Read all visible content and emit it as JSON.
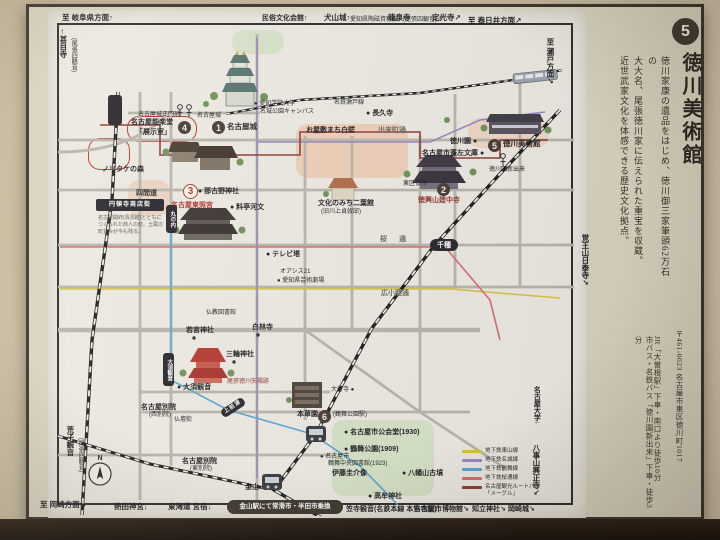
{
  "panel": {
    "badge_number": "5",
    "title": "徳川美術館",
    "body_lines": [
      "徳川家康の遺品をはじめ、徳川御三家筆頭62万石の",
      "大大名、尾張徳川家に伝えられた重宝を収蔵。",
      "近世武家文化を体感できる歴史文化拠点。"
    ],
    "address": "〒461-0023 名古屋市東区徳川町1017",
    "access_lines": [
      "JR「大曽根駅」下車・南口より徒歩10分",
      "市バス・名鉄バス「徳川園新出来」下車・徒歩3分"
    ]
  },
  "map": {
    "compass": "N",
    "labels": [
      {
        "t": "至 岐阜県方面↑",
        "x": 62,
        "y": 14,
        "c": "m"
      },
      {
        "t": "民俗文化会館↑",
        "x": 262,
        "y": 15,
        "c": "sm"
      },
      {
        "t": "犬山城↑",
        "x": 324,
        "y": 14,
        "c": "m"
      },
      {
        "t": "愛知県陶磁資料館↗",
        "x": 350,
        "y": 17,
        "c": "xs"
      },
      {
        "t": "龍泉寺",
        "x": 388,
        "y": 14,
        "c": "m"
      },
      {
        "t": "(尾張四観音)↗",
        "x": 403,
        "y": 17,
        "c": "xs"
      },
      {
        "t": "定光寺↗",
        "x": 432,
        "y": 14,
        "c": "m"
      },
      {
        "t": "至 春日井方面↗",
        "x": 468,
        "y": 17,
        "c": "m"
      },
      {
        "t": "←甚目寺",
        "x": 59,
        "y": 28,
        "c": "m vert"
      },
      {
        "t": "(尾張四観音)",
        "x": 70,
        "y": 38,
        "c": "xs vert"
      },
      {
        "t": "至 瀬戸方面↗",
        "x": 546,
        "y": 38,
        "c": "m vert"
      },
      {
        "t": "覚王山日泰寺↗",
        "x": 581,
        "y": 234,
        "c": "m vert"
      },
      {
        "t": "名古屋大学↓",
        "x": 533,
        "y": 386,
        "c": "sm vert"
      },
      {
        "t": "八事山興正寺↘",
        "x": 532,
        "y": 444,
        "c": "m vert"
      },
      {
        "t": "荒子観音",
        "x": 66,
        "y": 426,
        "c": "m vert"
      },
      {
        "t": "(尾張四観音)",
        "x": 77,
        "y": 438,
        "c": "xs vert"
      },
      {
        "t": "至 岡崎方面↘",
        "x": 40,
        "y": 501,
        "c": "m"
      },
      {
        "t": "熱田神宮↓",
        "x": 114,
        "y": 503,
        "c": "m"
      },
      {
        "t": "東海道 宮宿↓",
        "x": 168,
        "y": 503,
        "c": "m"
      },
      {
        "t": "笠寺観音(名鉄本線 本笠寺駅)↓",
        "x": 346,
        "y": 506,
        "c": "sm"
      },
      {
        "t": "名古屋市博物館↘",
        "x": 414,
        "y": 506,
        "c": "sm"
      },
      {
        "t": "知立神社↘",
        "x": 472,
        "y": 506,
        "c": "sm"
      },
      {
        "t": "岡崎城↘",
        "x": 508,
        "y": 506,
        "c": "sm"
      },
      {
        "t": "名古屋城正門前",
        "x": 138,
        "y": 112,
        "c": "xs"
      },
      {
        "t": "名古屋城",
        "x": 197,
        "y": 113,
        "c": "xs"
      },
      {
        "t": "名古屋能楽堂",
        "x": 131,
        "y": 119,
        "c": "sm"
      },
      {
        "t": "「展示室」",
        "x": 136,
        "y": 129,
        "c": "sm"
      },
      {
        "t": "名古屋城",
        "x": 227,
        "y": 123,
        "c": "poi"
      },
      {
        "t": "● 愛知学院大学",
        "x": 254,
        "y": 101,
        "c": "xs"
      },
      {
        "t": "名城公園キャンパス",
        "x": 260,
        "y": 109,
        "c": "xs"
      },
      {
        "t": "名鉄瀬戸線",
        "x": 334,
        "y": 100,
        "c": "xs"
      },
      {
        "t": "● 長久寺",
        "x": 366,
        "y": 110,
        "c": "sm"
      },
      {
        "t": "出来町通",
        "x": 378,
        "y": 127,
        "c": "street"
      },
      {
        "t": "お屋敷まち白壁",
        "x": 306,
        "y": 127,
        "c": "sm"
      },
      {
        "t": "文化のみち二葉館",
        "x": 318,
        "y": 200,
        "c": "sm"
      },
      {
        "t": "(旧川上貞奴邸)",
        "x": 321,
        "y": 209,
        "c": "xs"
      },
      {
        "t": "徳川園 ●",
        "x": 450,
        "y": 138,
        "c": "sm"
      },
      {
        "t": "徳川美術館",
        "x": 503,
        "y": 140,
        "c": "poi"
      },
      {
        "t": "名古屋市蓬左文庫 ●",
        "x": 422,
        "y": 150,
        "c": "sm"
      },
      {
        "t": "東区役所",
        "x": 403,
        "y": 181,
        "c": "xs"
      },
      {
        "t": "徳興山建中寺",
        "x": 418,
        "y": 197,
        "c": "sm darkred"
      },
      {
        "t": "徳川園新出来",
        "x": 489,
        "y": 167,
        "c": "xs"
      },
      {
        "t": "● 那古野神社",
        "x": 198,
        "y": 188,
        "c": "sm"
      },
      {
        "t": "● 料亭河文",
        "x": 230,
        "y": 204,
        "c": "sm"
      },
      {
        "t": "名古屋東照宮",
        "x": 171,
        "y": 202,
        "c": "sm red"
      },
      {
        "t": "四間道",
        "x": 136,
        "y": 190,
        "c": "sm"
      },
      {
        "t": "ノリタケの森",
        "x": 102,
        "y": 166,
        "c": "sm"
      },
      {
        "t": "名古屋開府(清須越)とともに",
        "x": 98,
        "y": 216,
        "c": "xxs"
      },
      {
        "t": "つくられた商人の町。土蔵の",
        "x": 98,
        "y": 223,
        "c": "xxs"
      },
      {
        "t": "町並みが今も残る。",
        "x": 98,
        "y": 230,
        "c": "xxs"
      },
      {
        "t": "● テレビ塔",
        "x": 266,
        "y": 251,
        "c": "sm"
      },
      {
        "t": "オアシス21",
        "x": 280,
        "y": 269,
        "c": "xs"
      },
      {
        "t": "● 愛知県芸術劇場",
        "x": 277,
        "y": 278,
        "c": "xs"
      },
      {
        "t": "桜 通",
        "x": 380,
        "y": 236,
        "c": "street sp"
      },
      {
        "t": "広小路通",
        "x": 381,
        "y": 290,
        "c": "street"
      },
      {
        "t": "仏教図書館",
        "x": 206,
        "y": 310,
        "c": "xs"
      },
      {
        "t": "若宮神社",
        "x": 186,
        "y": 327,
        "c": "sm"
      },
      {
        "t": "白林寺",
        "x": 252,
        "y": 324,
        "c": "sm"
      },
      {
        "t": "三輪神社",
        "x": 226,
        "y": 351,
        "c": "sm"
      },
      {
        "t": "尾張徳川矢場跡",
        "x": 227,
        "y": 379,
        "c": "xs darkred"
      },
      {
        "t": "● 大須観音",
        "x": 177,
        "y": 384,
        "c": "sm"
      },
      {
        "t": "名古屋別院",
        "x": 141,
        "y": 404,
        "c": "sm"
      },
      {
        "t": "(西別院)",
        "x": 149,
        "y": 412,
        "c": "xs"
      },
      {
        "t": "仏壇街",
        "x": 174,
        "y": 417,
        "c": "xs"
      },
      {
        "t": "名古屋別院",
        "x": 182,
        "y": 458,
        "c": "sm"
      },
      {
        "t": "(東別院)",
        "x": 190,
        "y": 466,
        "c": "xs"
      },
      {
        "t": "大行寺 ●",
        "x": 331,
        "y": 387,
        "c": "xs"
      },
      {
        "t": "本草園",
        "x": 297,
        "y": 411,
        "c": "sm"
      },
      {
        "t": "(鶴舞公園駅)",
        "x": 333,
        "y": 412,
        "c": "xs"
      },
      {
        "t": "● 名古屋市公会堂(1930)",
        "x": 344,
        "y": 429,
        "c": "sm"
      },
      {
        "t": "● 鶴舞公園(1909)",
        "x": 344,
        "y": 446,
        "c": "sm"
      },
      {
        "t": "● 名古屋市",
        "x": 320,
        "y": 454,
        "c": "xs"
      },
      {
        "t": "鶴舞中央図書館(1923)",
        "x": 328,
        "y": 461,
        "c": "xs"
      },
      {
        "t": "伊藤圭介像",
        "x": 332,
        "y": 470,
        "c": "sm"
      },
      {
        "t": "● 八幡山古墳",
        "x": 402,
        "y": 470,
        "c": "sm"
      },
      {
        "t": "● 高牟神社",
        "x": 368,
        "y": 493,
        "c": "sm"
      },
      {
        "t": "金山",
        "x": 245,
        "y": 484,
        "c": "sm"
      }
    ],
    "badges": [
      {
        "n": "1",
        "x": 212,
        "y": 121
      },
      {
        "n": "2",
        "x": 437,
        "y": 183
      },
      {
        "n": "3",
        "x": 183,
        "y": 184,
        "v": "redv"
      },
      {
        "n": "4",
        "x": 178,
        "y": 121
      },
      {
        "n": "5",
        "x": 488,
        "y": 139
      },
      {
        "n": "6",
        "x": 318,
        "y": 410
      }
    ],
    "plates": [
      {
        "t": "円頓寺商店街",
        "x": 96,
        "y": 199,
        "w": 68,
        "h": 12,
        "c": "bar"
      },
      {
        "t": "",
        "x": 108,
        "y": 95,
        "w": 14,
        "h": 30,
        "c": "vbar"
      },
      {
        "t": "丸の内",
        "x": 166,
        "y": 205,
        "w": 11,
        "h": 28,
        "c": "vbar"
      },
      {
        "t": "大須観音",
        "x": 163,
        "y": 353,
        "w": 11,
        "h": 33,
        "c": "vbar"
      },
      {
        "t": "上前津",
        "x": 220,
        "y": 403,
        "w": 26,
        "h": 9,
        "c": "bar rot"
      },
      {
        "t": "千種",
        "x": 430,
        "y": 239,
        "w": 28,
        "h": 12,
        "c": "pill"
      },
      {
        "t": "金山駅にて常滑市・半田市乗換",
        "x": 227,
        "y": 500,
        "w": 116,
        "h": 14,
        "c": "pill wide"
      }
    ],
    "zones": [
      {
        "x": 296,
        "y": 124,
        "w": 112,
        "h": 54,
        "bg": "#efc3a6",
        "o": 0.7
      },
      {
        "x": 128,
        "y": 180,
        "w": 42,
        "h": 36,
        "bg": "#efc3a6",
        "o": 0.55
      },
      {
        "x": 468,
        "y": 118,
        "w": 80,
        "h": 30,
        "bg": "#efc3a6",
        "o": 0.5
      },
      {
        "x": 332,
        "y": 420,
        "w": 102,
        "h": 76,
        "bg": "#cfe0c0",
        "o": 0.8
      },
      {
        "x": 232,
        "y": 30,
        "w": 52,
        "h": 24,
        "bg": "#cfe0c0",
        "o": 0.7
      },
      {
        "x": 88,
        "y": 138,
        "w": 42,
        "h": 32,
        "bg": "none",
        "br": "#c0392b",
        "o": 1
      },
      {
        "x": 127,
        "y": 116,
        "w": 70,
        "h": 26,
        "bg": "none",
        "br": "#c0392b",
        "o": 1
      }
    ],
    "legend": [
      {
        "x": 462,
        "y": 448,
        "color": "#d9c33f",
        "label": "地下鉄東山線"
      },
      {
        "x": 462,
        "y": 457,
        "color": "#9b85c0",
        "label": "地下鉄名城線"
      },
      {
        "x": 462,
        "y": 466,
        "color": "#57a4d6",
        "label": "地下鉄鶴舞線"
      },
      {
        "x": 462,
        "y": 475,
        "color": "#d96a70",
        "label": "地下鉄桜通線"
      },
      {
        "x": 462,
        "y": 484,
        "color": "#8e3a30",
        "label": "名古屋観光ルートバス\n「メーグル」"
      }
    ],
    "line_colors": {
      "higashiyama": "#d9c33f",
      "meijo": "#9b85c0",
      "tsurumai": "#57a4d6",
      "sakuradori": "#d96a70",
      "meguru": "#8e3a30"
    }
  }
}
